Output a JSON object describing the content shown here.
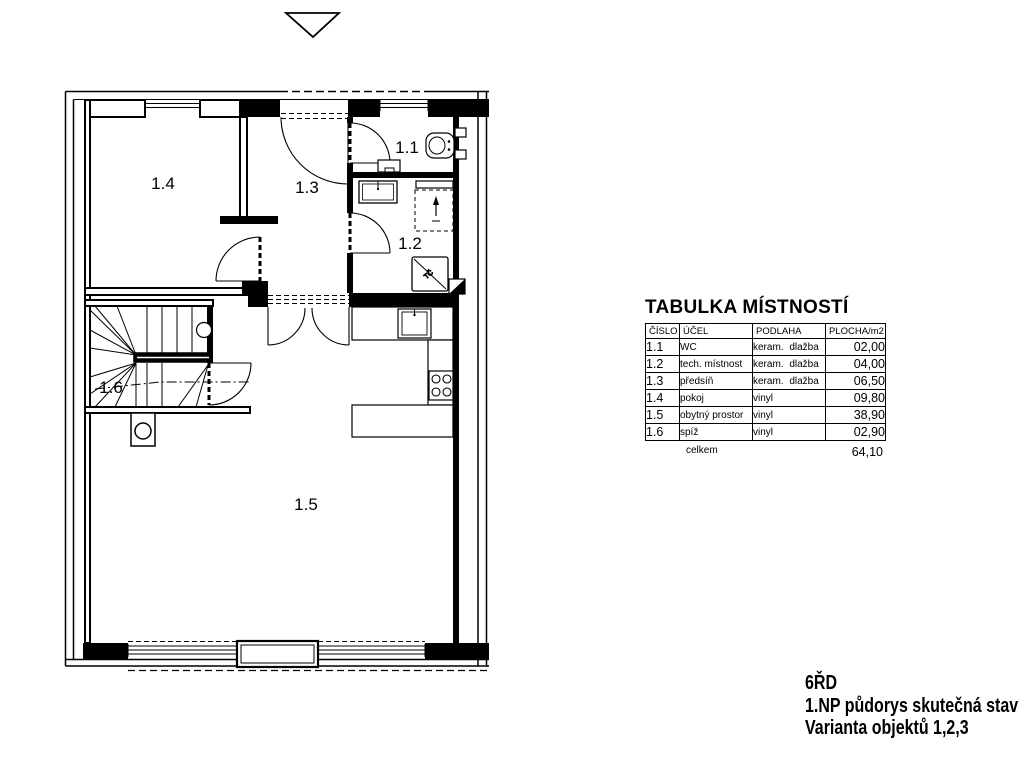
{
  "plan": {
    "room_labels": {
      "r14": "1.4",
      "r13": "1.3",
      "r11": "1.1",
      "r12": "1.2",
      "r16": "1.6",
      "r15": "1.5"
    },
    "fixtures": {
      "heat_pump_label": "TČ"
    }
  },
  "room_table": {
    "title": "TABULKA MÍSTNOSTÍ",
    "headers": {
      "number": "ČÍSLO",
      "purpose": "ÚČEL",
      "floor": "PODLAHA",
      "area": "PLOCHA/m2"
    },
    "rows": [
      {
        "number": "1.1",
        "purpose": "WC",
        "floor": "keram. dlažba",
        "area": "02,00"
      },
      {
        "number": "1.2",
        "purpose": "tech. místnost",
        "floor": "keram. dlažba",
        "area": "04,00"
      },
      {
        "number": "1.3",
        "purpose": "předsíň",
        "floor": "keram. dlažba",
        "area": "06,50"
      },
      {
        "number": "1.4",
        "purpose": "pokoj",
        "floor": "vinyl",
        "area": "09,80"
      },
      {
        "number": "1.5",
        "purpose": "obytný prostor",
        "floor": "vinyl",
        "area": "38,90"
      },
      {
        "number": "1.6",
        "purpose": "spíž",
        "floor": "vinyl",
        "area": "02,90"
      }
    ],
    "total_label": "celkem",
    "total_value": "64,10"
  },
  "title_block": {
    "line1": "6ŘD",
    "line2": "1.NP půdorys skutečná stav",
    "line3": "Varianta objektů 1,2,3"
  }
}
